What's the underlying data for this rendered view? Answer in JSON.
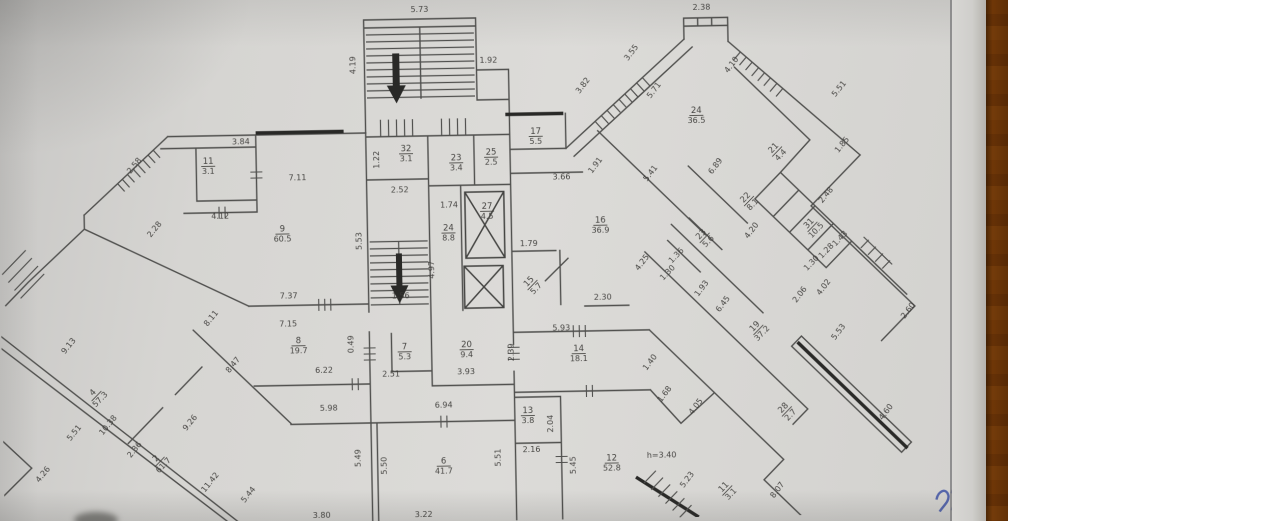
{
  "colors": {
    "paper": "#d6d5d2",
    "wall": "#4f4f4d",
    "wall_dark": "#2b2b29",
    "wood": "#a8762b",
    "ink": "#4153a5",
    "label": "#3c3b38"
  },
  "plan": {
    "note": {
      "text": "h=3.40",
      "x": 658,
      "y": 461,
      "r": 0
    },
    "dimensions": [
      {
        "t": "5.73",
        "x": 424,
        "y": 11,
        "r": 0
      },
      {
        "t": "4.19",
        "x": 359,
        "y": 63,
        "r": -90
      },
      {
        "t": "1.92",
        "x": 492,
        "y": 63,
        "r": 0
      },
      {
        "t": "2.38",
        "x": 706,
        "y": 14,
        "r": 0
      },
      {
        "t": "3.82",
        "x": 588,
        "y": 89,
        "r": -52
      },
      {
        "t": "3.55",
        "x": 637,
        "y": 57,
        "r": -52
      },
      {
        "t": "5.71",
        "x": 659,
        "y": 95,
        "r": -52
      },
      {
        "t": "4.10",
        "x": 737,
        "y": 71,
        "r": -52
      },
      {
        "t": "5.51",
        "x": 844,
        "y": 97,
        "r": -50
      },
      {
        "t": "1.85",
        "x": 846,
        "y": 153,
        "r": -50
      },
      {
        "t": "2.48",
        "x": 829,
        "y": 203,
        "r": -50
      },
      {
        "t": "3.84",
        "x": 243,
        "y": 140,
        "r": 0
      },
      {
        "t": "7.11",
        "x": 299,
        "y": 177,
        "r": 0
      },
      {
        "t": "4.12",
        "x": 221,
        "y": 214,
        "r": 0
      },
      {
        "t": "2.58",
        "x": 138,
        "y": 161,
        "r": -50
      },
      {
        "t": "2.28",
        "x": 157,
        "y": 225,
        "r": -50
      },
      {
        "t": "1.22",
        "x": 381,
        "y": 158,
        "r": -90
      },
      {
        "t": "2.52",
        "x": 401,
        "y": 191,
        "r": 0
      },
      {
        "t": "1.74",
        "x": 450,
        "y": 207,
        "r": 0
      },
      {
        "t": "4.97",
        "x": 434,
        "y": 269,
        "r": -90
      },
      {
        "t": "5.53",
        "x": 362,
        "y": 239,
        "r": -90
      },
      {
        "t": "1.79",
        "x": 529,
        "y": 247,
        "r": 0
      },
      {
        "t": "3.66",
        "x": 563,
        "y": 181,
        "r": 0
      },
      {
        "t": "1.91",
        "x": 599,
        "y": 169,
        "r": -52
      },
      {
        "t": "5.41",
        "x": 654,
        "y": 178,
        "r": -52
      },
      {
        "t": "6.89",
        "x": 719,
        "y": 172,
        "r": -52
      },
      {
        "t": "4.25",
        "x": 644,
        "y": 267,
        "r": -52
      },
      {
        "t": "4.20",
        "x": 754,
        "y": 237,
        "r": -52
      },
      {
        "t": "1.93",
        "x": 703,
        "y": 294,
        "r": -52
      },
      {
        "t": "6.45",
        "x": 724,
        "y": 310,
        "r": -52
      },
      {
        "t": "1.36",
        "x": 678,
        "y": 261,
        "r": -45
      },
      {
        "t": "1.30",
        "x": 669,
        "y": 278,
        "r": -45
      },
      {
        "t": "1.43",
        "x": 842,
        "y": 247,
        "r": -45
      },
      {
        "t": "1.28",
        "x": 828,
        "y": 259,
        "r": -45
      },
      {
        "t": "1.30",
        "x": 813,
        "y": 271,
        "r": -45
      },
      {
        "t": "4.02",
        "x": 825,
        "y": 295,
        "r": -52
      },
      {
        "t": "2.06",
        "x": 801,
        "y": 302,
        "r": -52
      },
      {
        "t": "2.60",
        "x": 909,
        "y": 320,
        "r": -52
      },
      {
        "t": "5.53",
        "x": 839,
        "y": 340,
        "r": -52
      },
      {
        "t": "4.60",
        "x": 885,
        "y": 421,
        "r": -52
      },
      {
        "t": "2.30",
        "x": 602,
        "y": 302,
        "r": 0
      },
      {
        "t": "5.93",
        "x": 560,
        "y": 332,
        "r": 0
      },
      {
        "t": "1.40",
        "x": 650,
        "y": 367,
        "r": -52
      },
      {
        "t": "1.68",
        "x": 664,
        "y": 399,
        "r": -52
      },
      {
        "t": "4.05",
        "x": 695,
        "y": 412,
        "r": -52
      },
      {
        "t": "5.23",
        "x": 685,
        "y": 485,
        "r": -52
      },
      {
        "t": "8.07",
        "x": 775,
        "y": 497,
        "r": -52
      },
      {
        "t": "7.37",
        "x": 288,
        "y": 295,
        "r": 0
      },
      {
        "t": "7.15",
        "x": 287,
        "y": 323,
        "r": 0
      },
      {
        "t": "0.49",
        "x": 352,
        "y": 342,
        "r": -90
      },
      {
        "t": "6.22",
        "x": 322,
        "y": 370,
        "r": 0
      },
      {
        "t": "2.51",
        "x": 389,
        "y": 375,
        "r": 0
      },
      {
        "t": "1.56",
        "x": 400,
        "y": 297,
        "r": 0
      },
      {
        "t": "3.93",
        "x": 464,
        "y": 374,
        "r": 0
      },
      {
        "t": "2.39",
        "x": 512,
        "y": 353,
        "r": -90
      },
      {
        "t": "5.98",
        "x": 326,
        "y": 408,
        "r": 0
      },
      {
        "t": "6.94",
        "x": 441,
        "y": 407,
        "r": 0
      },
      {
        "t": "2.16",
        "x": 528,
        "y": 453,
        "r": 0
      },
      {
        "t": "2.04",
        "x": 550,
        "y": 425,
        "r": -90
      },
      {
        "t": "5.45",
        "x": 572,
        "y": 467,
        "r": -90
      },
      {
        "t": "5.49",
        "x": 357,
        "y": 456,
        "r": -90
      },
      {
        "t": "5.50",
        "x": 383,
        "y": 464,
        "r": -90
      },
      {
        "t": "5.51",
        "x": 497,
        "y": 458,
        "r": -90
      },
      {
        "t": "3.80",
        "x": 317,
        "y": 515,
        "r": 0
      },
      {
        "t": "3.22",
        "x": 419,
        "y": 516,
        "r": 0
      },
      {
        "t": "9.13",
        "x": 69,
        "y": 340,
        "r": -50
      },
      {
        "t": "5.51",
        "x": 73,
        "y": 427,
        "r": -50
      },
      {
        "t": "10.38",
        "x": 107,
        "y": 420,
        "r": -50
      },
      {
        "t": "2.36",
        "x": 133,
        "y": 445,
        "r": -50
      },
      {
        "t": "4.26",
        "x": 41,
        "y": 468,
        "r": -50
      },
      {
        "t": "9.26",
        "x": 189,
        "y": 419,
        "r": -50
      },
      {
        "t": "8.47",
        "x": 233,
        "y": 362,
        "r": -50
      },
      {
        "t": "8.11",
        "x": 212,
        "y": 315,
        "r": -50
      },
      {
        "t": "11.42",
        "x": 208,
        "y": 479,
        "r": -50
      },
      {
        "t": "5.44",
        "x": 246,
        "y": 492,
        "r": -50
      }
    ],
    "rooms": [
      {
        "n": "11",
        "a": "3.1",
        "x": 210,
        "y": 160,
        "r": 0
      },
      {
        "n": "9",
        "a": "60.5",
        "x": 283,
        "y": 229,
        "r": 0
      },
      {
        "n": "32",
        "a": "3.1",
        "x": 408,
        "y": 151,
        "r": 0
      },
      {
        "n": "23",
        "a": "3.4",
        "x": 458,
        "y": 161,
        "r": 0
      },
      {
        "n": "25",
        "a": "2.5",
        "x": 493,
        "y": 156,
        "r": 0
      },
      {
        "n": "17",
        "a": "5.5",
        "x": 538,
        "y": 136,
        "r": 0
      },
      {
        "n": "24",
        "a": "8.8",
        "x": 449,
        "y": 231,
        "r": 0
      },
      {
        "n": "27",
        "a": "4.5",
        "x": 488,
        "y": 210,
        "r": 0
      },
      {
        "n": "15",
        "a": "5.7",
        "x": 531,
        "y": 285,
        "r": -45
      },
      {
        "n": "16",
        "a": "36.9",
        "x": 601,
        "y": 226,
        "r": 0
      },
      {
        "n": "24",
        "a": "36.5",
        "x": 699,
        "y": 118,
        "r": 0
      },
      {
        "n": "21",
        "a": "4.4",
        "x": 778,
        "y": 156,
        "r": -45
      },
      {
        "n": "22",
        "a": "8.1",
        "x": 749,
        "y": 205,
        "r": -45
      },
      {
        "n": "23",
        "a": "5.6",
        "x": 704,
        "y": 241,
        "r": -45
      },
      {
        "n": "31",
        "a": "10.5",
        "x": 812,
        "y": 232,
        "r": -45
      },
      {
        "n": "19",
        "a": "37.2",
        "x": 756,
        "y": 334,
        "r": -45
      },
      {
        "n": "8",
        "a": "19.7",
        "x": 297,
        "y": 341,
        "r": 0
      },
      {
        "n": "7",
        "a": "5.3",
        "x": 403,
        "y": 349,
        "r": 0
      },
      {
        "n": "20",
        "a": "9.4",
        "x": 465,
        "y": 348,
        "r": 0
      },
      {
        "n": "14",
        "a": "18.1",
        "x": 577,
        "y": 354,
        "r": 0
      },
      {
        "n": "13",
        "a": "3.8",
        "x": 525,
        "y": 415,
        "r": 0
      },
      {
        "n": "6",
        "a": "41.7",
        "x": 440,
        "y": 464,
        "r": 0
      },
      {
        "n": "12",
        "a": "52.8",
        "x": 608,
        "y": 464,
        "r": 0
      },
      {
        "n": "4",
        "a": "57.3",
        "x": 93,
        "y": 388,
        "r": -45
      },
      {
        "n": "2",
        "a": "61.7",
        "x": 155,
        "y": 455,
        "r": -45
      },
      {
        "n": "28",
        "a": "2.7",
        "x": 783,
        "y": 416,
        "r": -45
      },
      {
        "n": "11",
        "a": "3.1",
        "x": 722,
        "y": 494,
        "r": -45
      }
    ]
  }
}
